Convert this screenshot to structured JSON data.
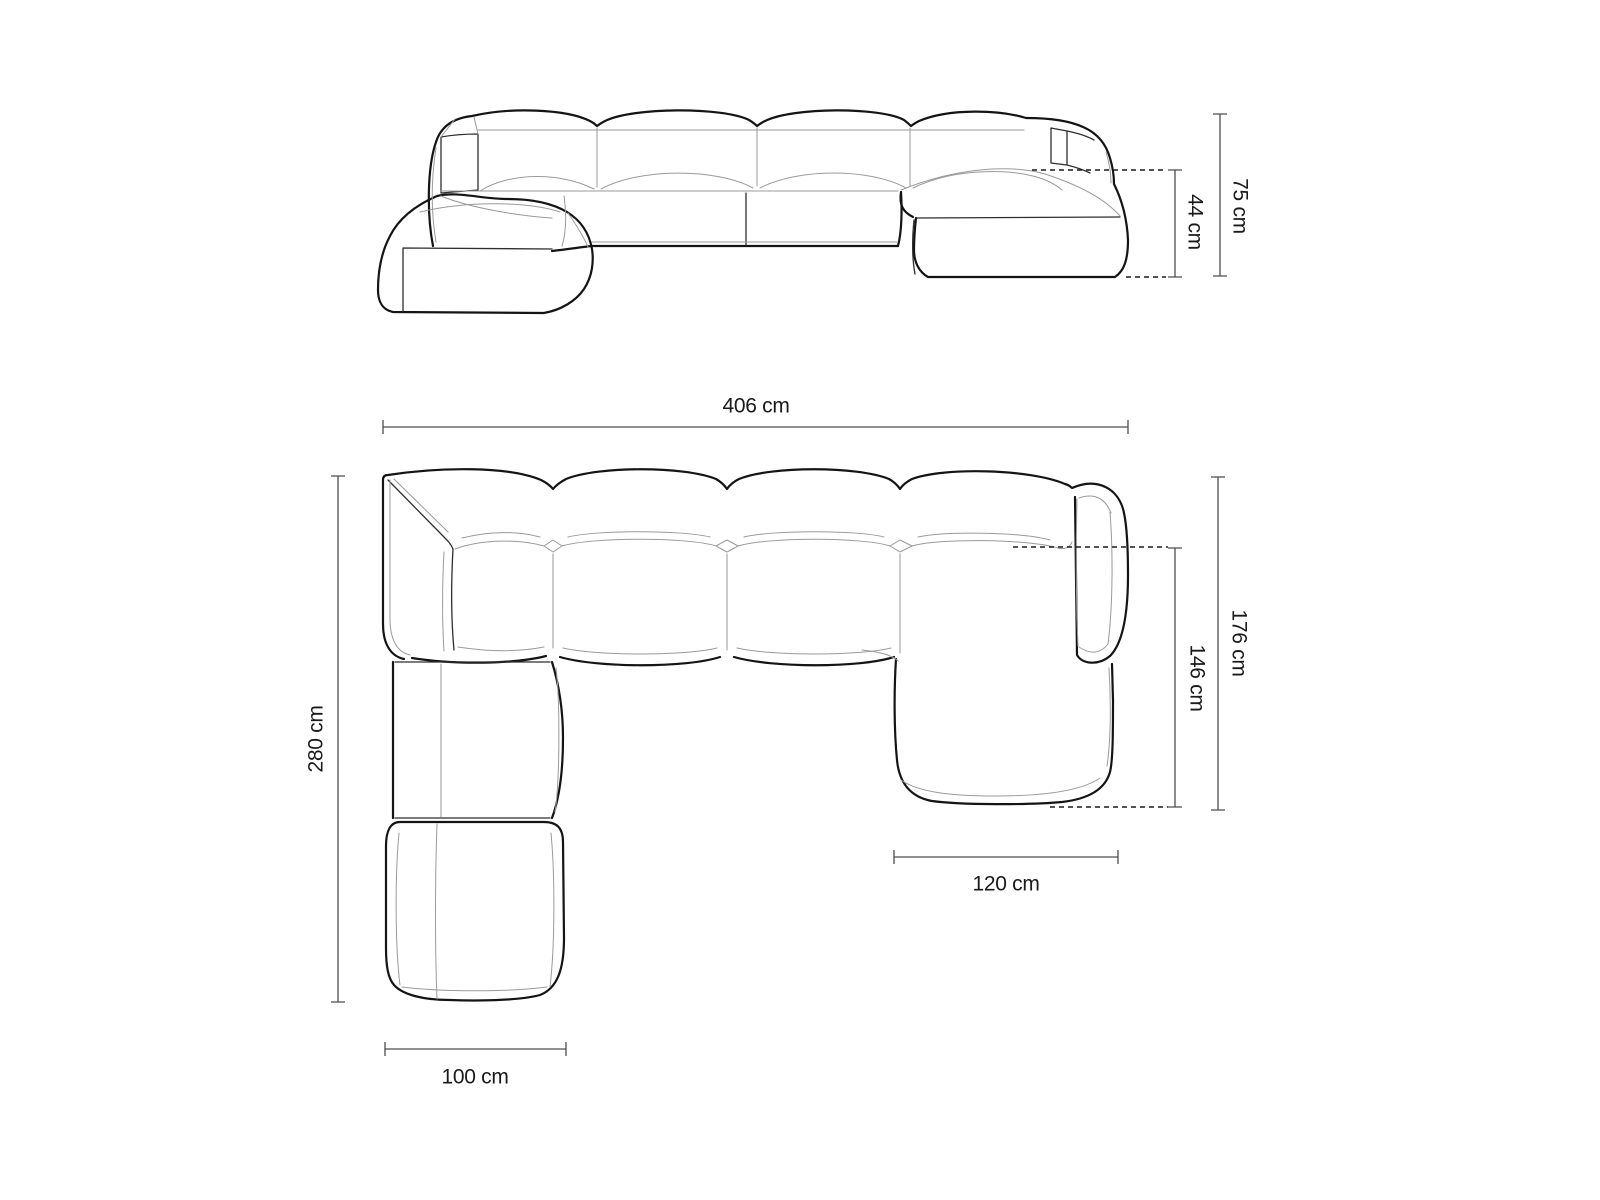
{
  "diagram": {
    "kind": "furniture-dimension-drawing",
    "subject": "modular panoramic corner sofa, two orthographic views",
    "unit": "cm",
    "background_color": "#ffffff",
    "outline_color": "#141414",
    "seam_color": "#9a9a9a",
    "dimension_line_color": "#4d4d4d",
    "label_color": "#1a1a1a"
  },
  "front_view": {
    "name": "front elevation view",
    "dimensions": {
      "seat_height": {
        "label": "44 cm",
        "value": 44,
        "orientation": "vertical"
      },
      "total_height": {
        "label": "75 cm",
        "value": 75,
        "orientation": "vertical"
      }
    }
  },
  "top_view": {
    "name": "top plan view",
    "dimensions": {
      "total_width": {
        "label": "406 cm",
        "value": 406,
        "orientation": "horizontal"
      },
      "left_depth": {
        "label": "280 cm",
        "value": 280,
        "orientation": "vertical"
      },
      "right_depth": {
        "label": "176 cm",
        "value": 176,
        "orientation": "vertical"
      },
      "chaise_depth": {
        "label": "146 cm",
        "value": 146,
        "orientation": "vertical"
      },
      "chaise_width": {
        "label": "120 cm",
        "value": 120,
        "orientation": "horizontal"
      },
      "ottoman_width": {
        "label": "100 cm",
        "value": 100,
        "orientation": "horizontal"
      }
    }
  }
}
